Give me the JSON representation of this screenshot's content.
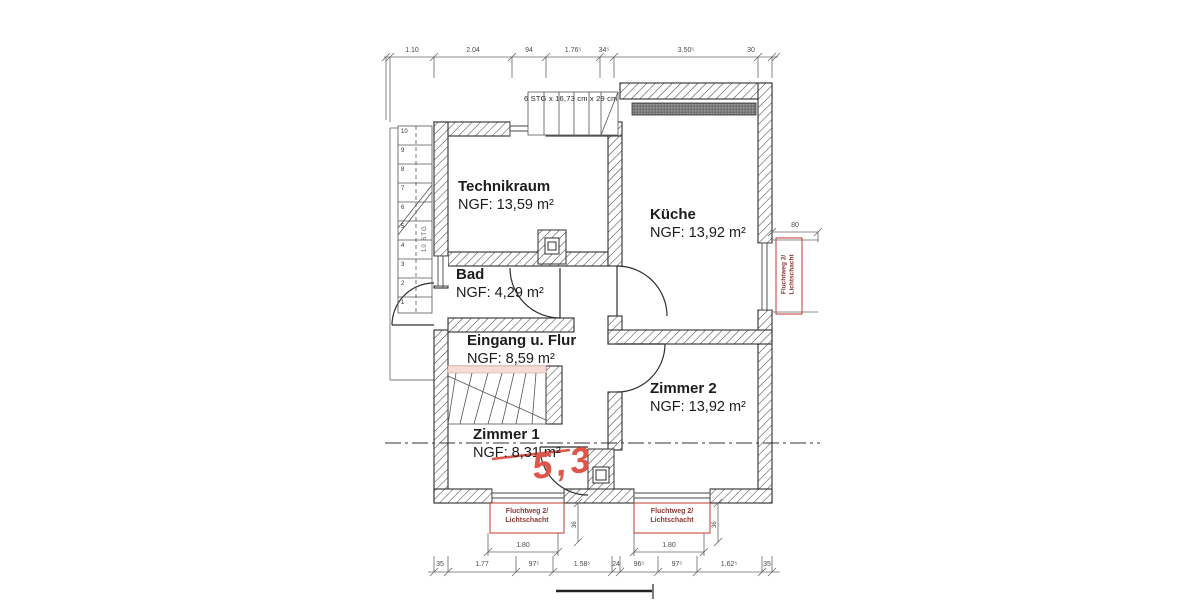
{
  "rooms": [
    {
      "name": "Technikraum",
      "area": "NGF: 13,59 m²"
    },
    {
      "name": "Küche",
      "area": "NGF: 13,92 m²"
    },
    {
      "name": "Bad",
      "area": "NGF: 4,29 m²"
    },
    {
      "name": "Eingang u. Flur",
      "area": "NGF: 8,59 m²"
    },
    {
      "name": "Zimmer 2",
      "area": "NGF: 13,92 m²"
    },
    {
      "name": "Zimmer 1",
      "area": "NGF: 8,31 m²"
    }
  ],
  "stairs": {
    "top_label": "6 STG x 16,73 cm x 29 cm",
    "left_label": "10 STG",
    "left_step_numbers": [
      "10",
      "9",
      "8",
      "7",
      "6",
      "5",
      "4",
      "3",
      "2",
      "1"
    ]
  },
  "escape_routes": {
    "right": {
      "line1": "Fluchtweg 2/",
      "line2": "Lichtschacht"
    },
    "bottom_left": {
      "line1": "Fluchtweg 2/",
      "line2": "Lichtschacht"
    },
    "bottom_right": {
      "line1": "Fluchtweg 2/",
      "line2": "Lichtschacht"
    }
  },
  "correction": {
    "value": "5,3"
  },
  "dimensions": {
    "top": [
      "1.10",
      "2.04",
      "94",
      "1.76⁵",
      "34⁵",
      "3.50⁵",
      "30"
    ],
    "bottom": [
      "35",
      "1.77",
      "97⁵",
      "1.58⁵",
      "24",
      "96⁵",
      "97⁵",
      "1.62⁵",
      "35"
    ],
    "right_offset": "80",
    "lightwell_width_left": "1.80",
    "lightwell_width_right": "1.80",
    "lightwell_depth_left": "36",
    "lightwell_depth_right": "36"
  },
  "colors": {
    "wall_line": "#2f2f2f",
    "dimension_line": "#555555",
    "red_annotation": "#c0392b",
    "handwriting": "#e0554a"
  }
}
